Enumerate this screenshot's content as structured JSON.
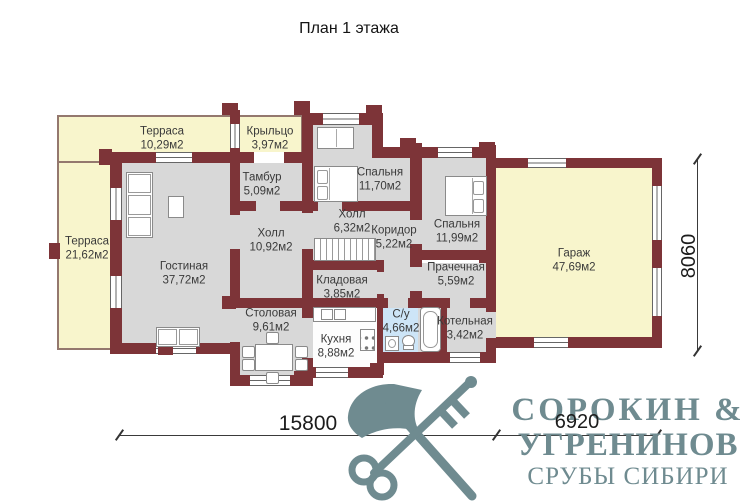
{
  "title": "План 1 этажа",
  "rooms": [
    {
      "id": "terrace-top",
      "name": "Терраса",
      "area": "10,29м2"
    },
    {
      "id": "porch",
      "name": "Крыльцо",
      "area": "3,97м2"
    },
    {
      "id": "tambour",
      "name": "Тамбур",
      "area": "5,09м2"
    },
    {
      "id": "bedroom-1",
      "name": "Спальня",
      "area": "11,70м2"
    },
    {
      "id": "terrace-left",
      "name": "Терраса",
      "area": "21,62м2"
    },
    {
      "id": "hall-main",
      "name": "Холл",
      "area": "10,92м2"
    },
    {
      "id": "hall-stairs",
      "name": "Холл",
      "area": "6,32м2"
    },
    {
      "id": "corridor",
      "name": "Коридор",
      "area": "5,22м2"
    },
    {
      "id": "bedroom-2",
      "name": "Спальня",
      "area": "11,99м2"
    },
    {
      "id": "living-room",
      "name": "Гостиная",
      "area": "37,72м2"
    },
    {
      "id": "pantry",
      "name": "Кладовая",
      "area": "3,85м2"
    },
    {
      "id": "laundry",
      "name": "Прачечная",
      "area": "5,59м2"
    },
    {
      "id": "garage",
      "name": "Гараж",
      "area": "47,69м2"
    },
    {
      "id": "dining-room",
      "name": "Столовая",
      "area": "9,61м2"
    },
    {
      "id": "kitchen",
      "name": "Кухня",
      "area": "8,88м2"
    },
    {
      "id": "bathroom",
      "name": "С/у",
      "area": "4,66м2"
    },
    {
      "id": "boiler-room",
      "name": "Котельная",
      "area": "3,42м2"
    }
  ],
  "dimensions": {
    "total_width_mm": "15800",
    "garage_width_mm": "6920",
    "height_mm": "8060"
  },
  "logo": {
    "line1": "СОРОКИН &",
    "line2": "УГРЕНИНОВ",
    "line3": "СРУБЫ СИБИРИ"
  },
  "colors": {
    "wall": "#7d3438",
    "terrace": "#f8f5cc",
    "room": "#d8d8d8",
    "bathroom": "#cde5f7",
    "logo": "#6f8b90"
  }
}
